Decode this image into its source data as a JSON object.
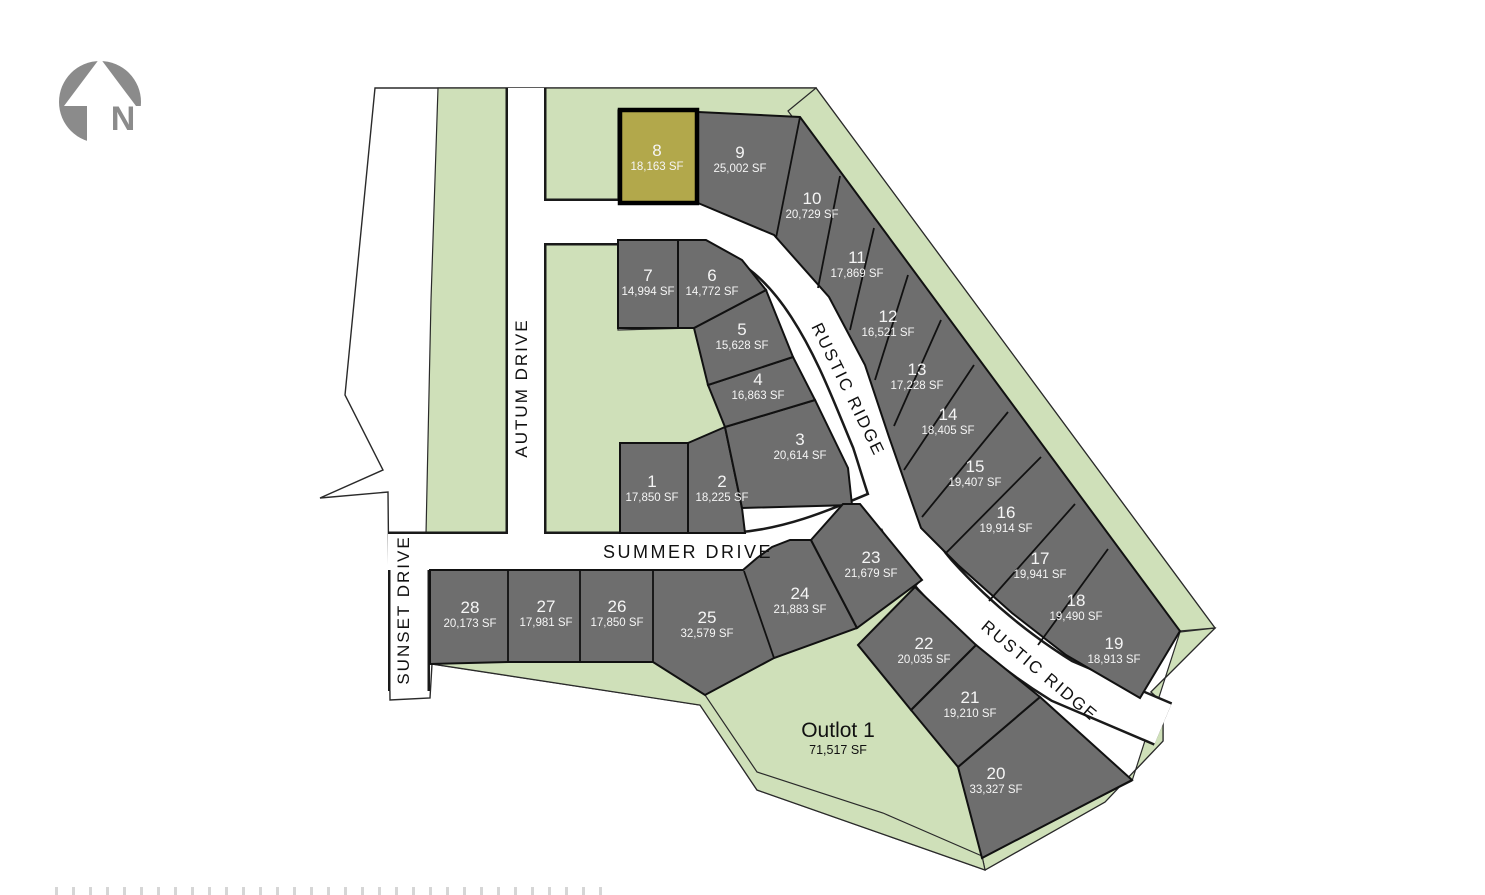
{
  "map": {
    "north_label": "N",
    "highlighted_lot": "8",
    "roads": [
      {
        "id": "autum",
        "label": "AUTUM DRIVE"
      },
      {
        "id": "sunset",
        "label": "SUNSET DRIVE"
      },
      {
        "id": "summer",
        "label": "SUMMER DRIVE"
      },
      {
        "id": "rustic",
        "label": "RUSTIC RIDGE"
      }
    ],
    "lots": [
      {
        "id": "1",
        "number": "1",
        "area": "17,850 SF",
        "highlighted": false
      },
      {
        "id": "2",
        "number": "2",
        "area": "18,225 SF",
        "highlighted": false
      },
      {
        "id": "3",
        "number": "3",
        "area": "20,614 SF",
        "highlighted": false
      },
      {
        "id": "4",
        "number": "4",
        "area": "16,863 SF",
        "highlighted": false
      },
      {
        "id": "5",
        "number": "5",
        "area": "15,628 SF",
        "highlighted": false
      },
      {
        "id": "6",
        "number": "6",
        "area": "14,772 SF",
        "highlighted": false
      },
      {
        "id": "7",
        "number": "7",
        "area": "14,994 SF",
        "highlighted": false
      },
      {
        "id": "8",
        "number": "8",
        "area": "18,163 SF",
        "highlighted": true
      },
      {
        "id": "9",
        "number": "9",
        "area": "25,002 SF",
        "highlighted": false
      },
      {
        "id": "10",
        "number": "10",
        "area": "20,729 SF",
        "highlighted": false
      },
      {
        "id": "11",
        "number": "11",
        "area": "17,869 SF",
        "highlighted": false
      },
      {
        "id": "12",
        "number": "12",
        "area": "16,521 SF",
        "highlighted": false
      },
      {
        "id": "13",
        "number": "13",
        "area": "17,228 SF",
        "highlighted": false
      },
      {
        "id": "14",
        "number": "14",
        "area": "18,405 SF",
        "highlighted": false
      },
      {
        "id": "15",
        "number": "15",
        "area": "19,407 SF",
        "highlighted": false
      },
      {
        "id": "16",
        "number": "16",
        "area": "19,914 SF",
        "highlighted": false
      },
      {
        "id": "17",
        "number": "17",
        "area": "19,941 SF",
        "highlighted": false
      },
      {
        "id": "18",
        "number": "18",
        "area": "19,490 SF",
        "highlighted": false
      },
      {
        "id": "19",
        "number": "19",
        "area": "18,913 SF",
        "highlighted": false
      },
      {
        "id": "20",
        "number": "20",
        "area": "33,327 SF",
        "highlighted": false
      },
      {
        "id": "21",
        "number": "21",
        "area": "19,210 SF",
        "highlighted": false
      },
      {
        "id": "22",
        "number": "22",
        "area": "20,035 SF",
        "highlighted": false
      },
      {
        "id": "23",
        "number": "23",
        "area": "21,679 SF",
        "highlighted": false
      },
      {
        "id": "24",
        "number": "24",
        "area": "21,883 SF",
        "highlighted": false
      },
      {
        "id": "25",
        "number": "25",
        "area": "32,579 SF",
        "highlighted": false
      },
      {
        "id": "26",
        "number": "26",
        "area": "17,850 SF",
        "highlighted": false
      },
      {
        "id": "27",
        "number": "27",
        "area": "17,981 SF",
        "highlighted": false
      },
      {
        "id": "28",
        "number": "28",
        "area": "20,173 SF",
        "highlighted": false
      },
      {
        "id": "outlot",
        "number": "Outlot 1",
        "area": "71,517 SF",
        "highlighted": false,
        "dark": true
      }
    ],
    "colors": {
      "lot_gray": "#6e6e6e",
      "highlight": "#b2a84b",
      "green": "#cfe0b9",
      "road_white": "#ffffff",
      "lot_text": "#f5f5f5",
      "north_gray": "#8b8b8b"
    }
  }
}
